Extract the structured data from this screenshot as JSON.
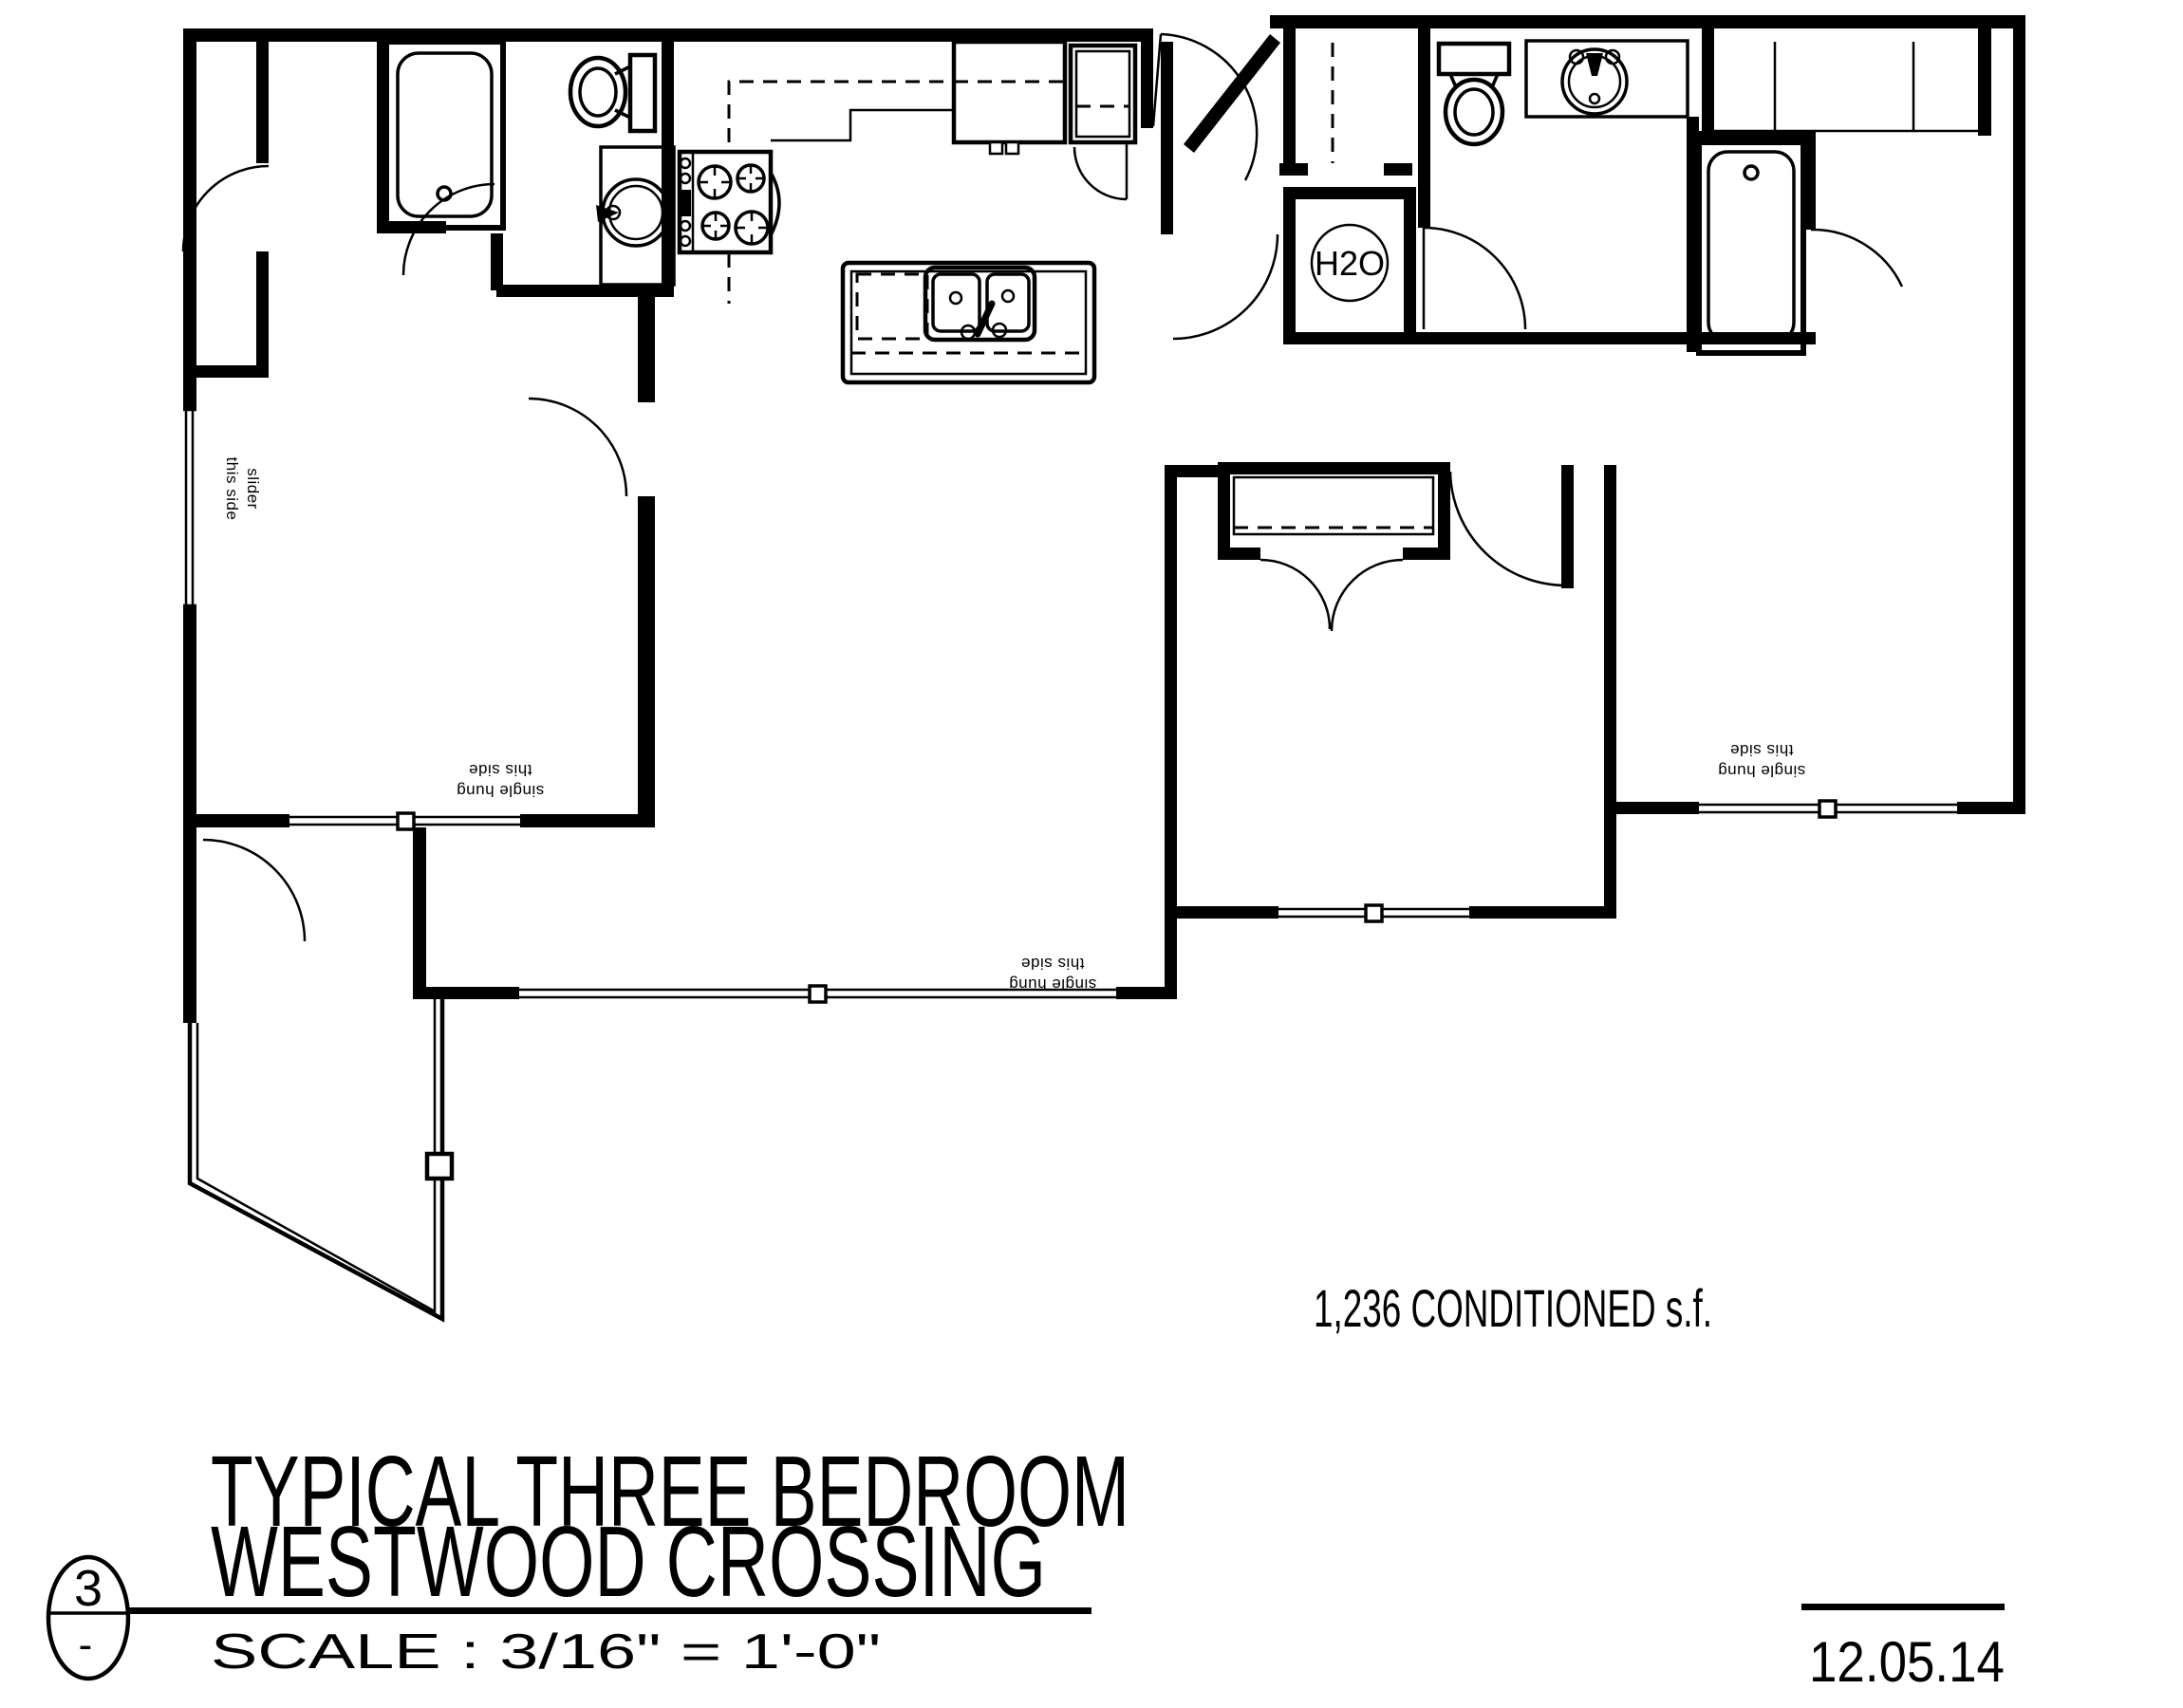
{
  "colors": {
    "ink": "#000000",
    "paper": "#ffffff"
  },
  "annotations": {
    "slider_line1": "slider",
    "slider_line2": "this side",
    "single_hung_line1": "single hung",
    "single_hung_line2": "this side",
    "water_heater": "H2O",
    "area": "1,236 CONDITIONED  s.f."
  },
  "title_block": {
    "detail_number": "3",
    "detail_dash": "-",
    "title_line1": "TYPICAL THREE BEDROOM",
    "title_line2": "WESTWOOD CROSSING",
    "scale": "SCALE : 3/16\" = 1'-0\"",
    "date": "12.05.14"
  }
}
